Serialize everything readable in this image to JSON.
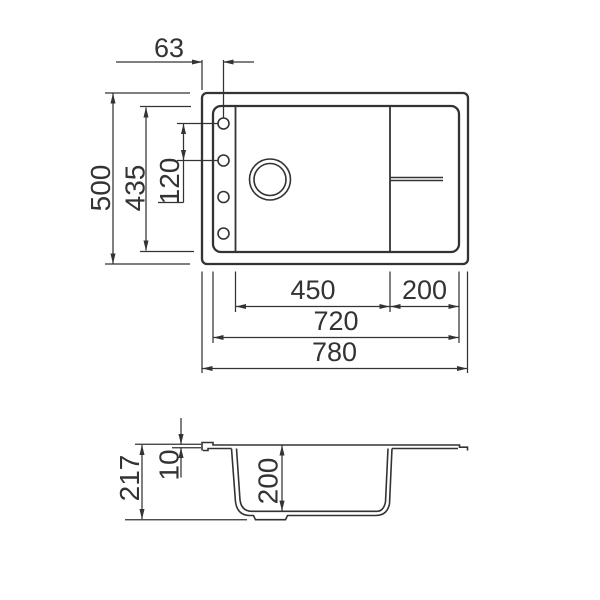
{
  "drawing": {
    "top_view": {
      "hole_offset": "63",
      "overall_depth": "500",
      "inner_depth": "435",
      "hole_spacing": "120",
      "bowl_width": "450",
      "drainer_width": "200",
      "inner_width": "720",
      "overall_width": "780"
    },
    "side_view": {
      "total_height": "217",
      "rim_thickness": "10",
      "bowl_depth": "200"
    },
    "colors": {
      "line": "#333333",
      "background": "#ffffff"
    }
  }
}
